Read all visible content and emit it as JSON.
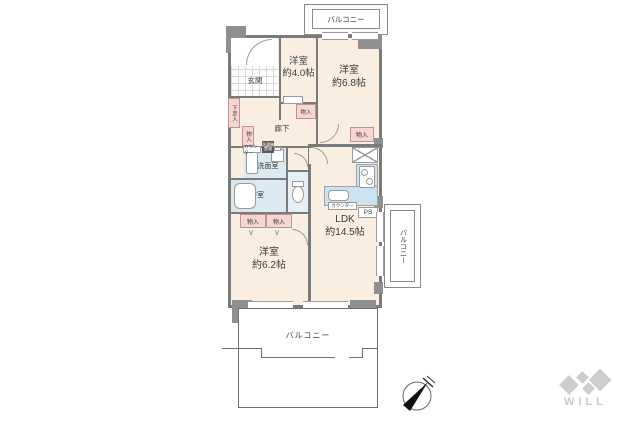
{
  "colors": {
    "room_fill": "#faeee1",
    "closet_fill": "#f6d6d2",
    "wet_fill": "#dbe9f3",
    "kitchen_fill": "#cde1ef",
    "wall": "#7a7a7a",
    "text": "#3b3b3b",
    "logo_gray": "#c9c9c9"
  },
  "rooms": {
    "r40": {
      "name": "洋室",
      "size": "約4.0帖"
    },
    "r68": {
      "name": "洋室",
      "size": "約6.8帖"
    },
    "r62": {
      "name": "洋室",
      "size": "約6.2帖"
    },
    "ldk": {
      "name": "LDK",
      "size": "約14.5帖"
    },
    "genkan": "玄関",
    "rouka": "廊下",
    "senmen": "洗面室",
    "bath": "浴室"
  },
  "labels": {
    "balcony": "バルコニー",
    "monoire": "物入",
    "getabako": "下足入",
    "counter": "カウンター",
    "washer_line1": "洗濯機",
    "washer_line2": "置場",
    "ps": "PS",
    "fold_mark": "∨"
  },
  "logo": {
    "text": "WILL"
  }
}
